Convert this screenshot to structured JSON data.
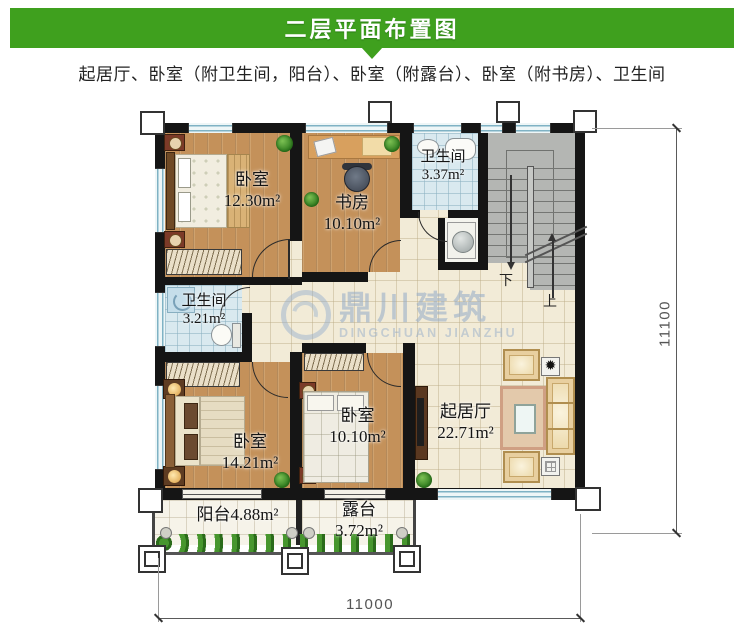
{
  "header": {
    "title": "二层平面布置图"
  },
  "subtitle": "起居厅、卧室（附卫生间，阳台）、卧室（附露台）、卧室（附书房）、卫生间",
  "colors": {
    "header_green": "#3fa01e",
    "wall_black": "#151515",
    "wood_floor": "#c4915a",
    "tile_cream": "#f2ebd7",
    "tile_blue": "#d9e9ef",
    "stairs_gray": "#b4b6b3",
    "watermark_blue": "#92aac8"
  },
  "rooms": {
    "bedroom_top_left": {
      "name": "卧室",
      "area": "12.30m²"
    },
    "study": {
      "name": "书房",
      "area": "10.10m²"
    },
    "bathroom_top": {
      "name": "卫生间",
      "area": "3.37m²"
    },
    "bathroom_left": {
      "name": "卫生间",
      "area": "3.21m²"
    },
    "bedroom_bottom_left": {
      "name": "卧室",
      "area": "14.21m²"
    },
    "bedroom_bottom_mid": {
      "name": "卧室",
      "area": "10.10m²"
    },
    "living_room": {
      "name": "起居厅",
      "area": "22.71m²"
    },
    "balcony": {
      "name": "阳台",
      "area": "4.88m²"
    },
    "terrace": {
      "name": "露台",
      "area": "3.72m²"
    }
  },
  "stairs": {
    "down_label": "下",
    "up_label": "上"
  },
  "dimensions": {
    "width_bottom": "11000",
    "height_right": "11100"
  },
  "watermark": {
    "brand": "鼎川建筑",
    "brand_latin": "DINGCHUAN JIANZHU"
  }
}
